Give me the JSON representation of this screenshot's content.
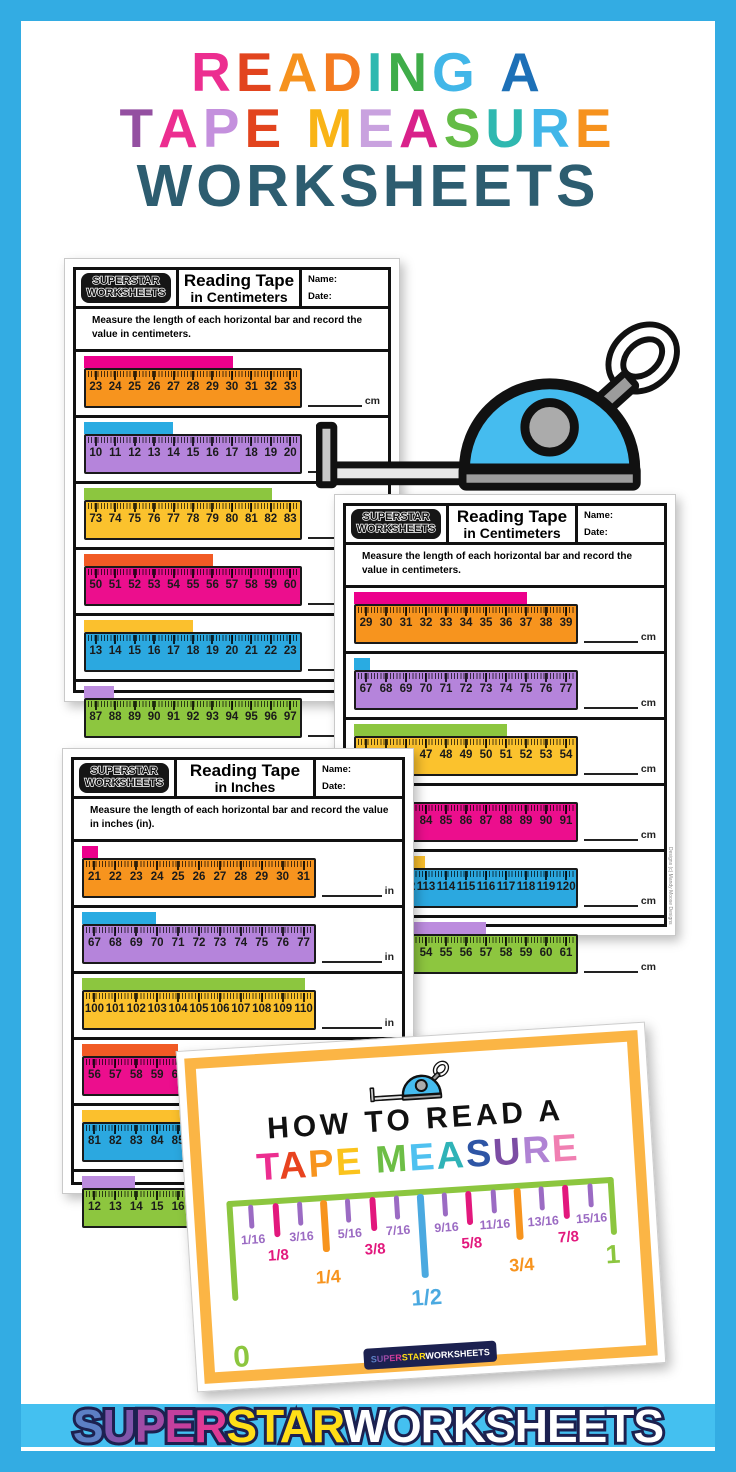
{
  "frame": {
    "border_color": "#33ACE3",
    "strip_color": "#44C0F0"
  },
  "title": {
    "line1": [
      [
        "R",
        "#EC2E90"
      ],
      [
        "E",
        "#E2441E"
      ],
      [
        "A",
        "#F6921E"
      ],
      [
        "D",
        "#F47B20"
      ],
      [
        "I",
        "#2FB8B0"
      ],
      [
        "N",
        "#3FAD49"
      ],
      [
        "G",
        "#41B6E8"
      ],
      [
        " ",
        ""
      ],
      [
        "A",
        "#1D70B7"
      ]
    ],
    "line2": [
      [
        "T",
        "#9450A1"
      ],
      [
        "A",
        "#EC2E90"
      ],
      [
        "P",
        "#C490DD"
      ],
      [
        "E",
        "#E2441E"
      ],
      [
        " ",
        ""
      ],
      [
        "M",
        "#F9B417"
      ],
      [
        "E",
        "#C9A2DF"
      ],
      [
        "A",
        "#D9218A"
      ],
      [
        "S",
        "#64BC46"
      ],
      [
        "U",
        "#2FB8B0"
      ],
      [
        "R",
        "#41B6E8"
      ],
      [
        "E",
        "#F6921E"
      ]
    ],
    "line3_text": "WORKSHEETS",
    "line3_color": "#2D5D70"
  },
  "worksheets": [
    {
      "mount": "ws1",
      "logo_line1": "SUPERSTAR",
      "logo_line2": "WORKSHEETS",
      "title_line1": "Reading Tape",
      "title_line2": "in Centimeters",
      "name_label": "Name:",
      "date_label": "Date:",
      "instructions": "Measure the length of each horizontal bar and record the value in centimeters.",
      "unit": "cm",
      "rulers": [
        {
          "ruler_color": "#F7941E",
          "bar_color": "#EC008C",
          "numbers": [
            "23",
            "24",
            "25",
            "26",
            "27",
            "28",
            "29",
            "30",
            "31",
            "32",
            "33"
          ],
          "bar_end": "30",
          "bar_pct": 68.2
        },
        {
          "ruler_color": "#B584DB",
          "bar_color": "#29ABE2",
          "numbers": [
            "10",
            "11",
            "12",
            "13",
            "14",
            "15",
            "16",
            "17",
            "18",
            "19",
            "20"
          ],
          "bar_end": "14",
          "bar_pct": 40.9
        },
        {
          "ruler_color": "#FBC22D",
          "bar_color": "#8CC63F",
          "numbers": [
            "73",
            "74",
            "75",
            "76",
            "77",
            "78",
            "79",
            "80",
            "81",
            "82",
            "83"
          ],
          "bar_end": "82",
          "bar_pct": 86.4
        },
        {
          "ruler_color": "#EC0E8D",
          "bar_color": "#F15A24",
          "numbers": [
            "50",
            "51",
            "52",
            "53",
            "54",
            "55",
            "56",
            "57",
            "58",
            "59",
            "60"
          ],
          "bar_end": "56",
          "bar_pct": 59.1
        },
        {
          "ruler_color": "#2BA8E0",
          "bar_color": "#FBC02D",
          "numbers": [
            "13",
            "14",
            "15",
            "16",
            "17",
            "18",
            "19",
            "20",
            "21",
            "22",
            "23"
          ],
          "bar_end": "18",
          "bar_pct": 50.0
        },
        {
          "ruler_color": "#8DC63F",
          "bar_color": "#BC8CDE",
          "numbers": [
            "87",
            "88",
            "89",
            "90",
            "91",
            "92",
            "93",
            "94",
            "95",
            "96",
            "97"
          ],
          "bar_end": "88",
          "bar_pct": 13.6
        }
      ]
    },
    {
      "mount": "ws2",
      "logo_line1": "SUPERSTAR",
      "logo_line2": "WORKSHEETS",
      "title_line1": "Reading Tape",
      "title_line2": "in Centimeters",
      "name_label": "Name:",
      "date_label": "Date:",
      "instructions": "Measure the length of each horizontal bar and record the value in centimeters.",
      "unit": "cm",
      "credit": "Designs (c) Mandy Moose Designs",
      "rulers": [
        {
          "ruler_color": "#F7941E",
          "bar_color": "#EC008C",
          "numbers": [
            "29",
            "30",
            "31",
            "32",
            "33",
            "34",
            "35",
            "36",
            "37",
            "38",
            "39"
          ],
          "bar_end": "37",
          "bar_pct": 77.3
        },
        {
          "ruler_color": "#B584DB",
          "bar_color": "#29ABE2",
          "numbers": [
            "67",
            "68",
            "69",
            "70",
            "71",
            "72",
            "73",
            "74",
            "75",
            "76",
            "77"
          ],
          "bar_end": "67",
          "bar_pct": 7.0
        },
        {
          "ruler_color": "#FBC22D",
          "bar_color": "#8CC63F",
          "numbers": [
            "44",
            "45",
            "46",
            "47",
            "48",
            "49",
            "50",
            "51",
            "52",
            "53",
            "54"
          ],
          "bar_end": "51",
          "bar_pct": 68.2
        },
        {
          "ruler_color": "#EC0E8D",
          "bar_color": "#F15A24",
          "numbers": [
            "81",
            "82",
            "83",
            "84",
            "85",
            "86",
            "87",
            "88",
            "89",
            "90",
            "91"
          ],
          "bar_end": "83",
          "bar_pct": 22.7
        },
        {
          "ruler_color": "#2BA8E0",
          "bar_color": "#FBC02D",
          "numbers": [
            "110",
            "111",
            "112",
            "113",
            "114",
            "115",
            "116",
            "117",
            "118",
            "119",
            "120"
          ],
          "bar_end": "113",
          "bar_pct": 31.8
        },
        {
          "ruler_color": "#8DC63F",
          "bar_color": "#BC8CDE",
          "numbers": [
            "51",
            "52",
            "53",
            "54",
            "55",
            "56",
            "57",
            "58",
            "59",
            "60",
            "61"
          ],
          "bar_end": "57",
          "bar_pct": 59.1
        }
      ]
    },
    {
      "mount": "ws3",
      "logo_line1": "SUPERSTAR",
      "logo_line2": "WORKSHEETS",
      "title_line1": "Reading Tape",
      "title_line2": "in Inches",
      "name_label": "Name:",
      "date_label": "Date:",
      "instructions": "Measure the length of each horizontal bar and record the value in inches (in).",
      "unit": "in",
      "rulers": [
        {
          "ruler_color": "#F7941E",
          "bar_color": "#EC008C",
          "numbers": [
            "21",
            "22",
            "23",
            "24",
            "25",
            "26",
            "27",
            "28",
            "29",
            "30",
            "31"
          ],
          "bar_end": "21",
          "bar_pct": 7.0
        },
        {
          "ruler_color": "#B584DB",
          "bar_color": "#29ABE2",
          "numbers": [
            "67",
            "68",
            "69",
            "70",
            "71",
            "72",
            "73",
            "74",
            "75",
            "76",
            "77"
          ],
          "bar_end": "70",
          "bar_pct": 31.8
        },
        {
          "ruler_color": "#FBC22D",
          "bar_color": "#8CC63F",
          "numbers": [
            "100",
            "101",
            "102",
            "103",
            "104",
            "105",
            "106",
            "107",
            "108",
            "109",
            "110"
          ],
          "bar_end": "110",
          "bar_pct": 95.5
        },
        {
          "ruler_color": "#EC0E8D",
          "bar_color": "#F15A24",
          "numbers": [
            "56",
            "57",
            "58",
            "59",
            "60",
            "61",
            "62",
            "63",
            "64",
            "65",
            "66"
          ],
          "bar_end": "60",
          "bar_pct": 40.9
        },
        {
          "ruler_color": "#2BA8E0",
          "bar_color": "#FBC02D",
          "numbers": [
            "81",
            "82",
            "83",
            "84",
            "85",
            "86",
            "87",
            "88",
            "89",
            "90",
            "91"
          ],
          "bar_end": "84",
          "bar_pct": 43.0
        },
        {
          "ruler_color": "#8DC63F",
          "bar_color": "#BC8CDE",
          "numbers": [
            "12",
            "13",
            "14",
            "15",
            "16",
            "17",
            "18",
            "19",
            "20",
            "21",
            "22"
          ],
          "bar_end": "14",
          "bar_pct": 22.7
        }
      ]
    }
  ],
  "howto": {
    "heading": "HOW TO READ A",
    "letters": [
      [
        "T",
        "#EC2E90"
      ],
      [
        "A",
        "#E8431F"
      ],
      [
        "P",
        "#F7941E"
      ],
      [
        "E",
        "#FBC31C"
      ],
      [
        " ",
        ""
      ],
      [
        "M",
        "#6DBE46"
      ],
      [
        "E",
        "#4FC1F0"
      ],
      [
        "A",
        "#2FB3B7"
      ],
      [
        "S",
        "#2E55A5"
      ],
      [
        "U",
        "#7C4DA4"
      ],
      [
        "R",
        "#B083D4"
      ],
      [
        "E",
        "#F07FB2"
      ]
    ],
    "zero": "0",
    "one": "1",
    "line_color": "#8CC63F",
    "ticks": [
      {
        "label": "1/16",
        "level": 16,
        "color": "#9B6BC3"
      },
      {
        "label": "1/8",
        "level": 8,
        "color": "#E2187D"
      },
      {
        "label": "3/16",
        "level": 16,
        "color": "#9B6BC3"
      },
      {
        "label": "1/4",
        "level": 4,
        "color": "#F7941E"
      },
      {
        "label": "5/16",
        "level": 16,
        "color": "#9B6BC3"
      },
      {
        "label": "3/8",
        "level": 8,
        "color": "#E2187D"
      },
      {
        "label": "7/16",
        "level": 16,
        "color": "#9B6BC3"
      },
      {
        "label": "1/2",
        "level": 2,
        "color": "#4BA9E0"
      },
      {
        "label": "9/16",
        "level": 16,
        "color": "#9B6BC3"
      },
      {
        "label": "5/8",
        "level": 8,
        "color": "#E2187D"
      },
      {
        "label": "11/16",
        "level": 16,
        "color": "#9B6BC3"
      },
      {
        "label": "3/4",
        "level": 4,
        "color": "#F7941E"
      },
      {
        "label": "13/16",
        "level": 16,
        "color": "#9B6BC3"
      },
      {
        "label": "7/8",
        "level": 8,
        "color": "#E2187D"
      },
      {
        "label": "15/16",
        "level": 16,
        "color": "#9B6BC3"
      }
    ]
  },
  "brand": {
    "segments": [
      {
        "text": "S",
        "color": "#5C7FC4"
      },
      {
        "text": "U",
        "color": "#8055AB"
      },
      {
        "text": "P",
        "color": "#9F4BA5"
      },
      {
        "text": "E",
        "color": "#C43F9D"
      },
      {
        "text": "R",
        "color": "#DE3A95"
      },
      {
        "text": "STAR",
        "color": "#FFDE17"
      },
      {
        "text": "WORKSHEETS",
        "color": "#FFFFFF"
      }
    ]
  }
}
